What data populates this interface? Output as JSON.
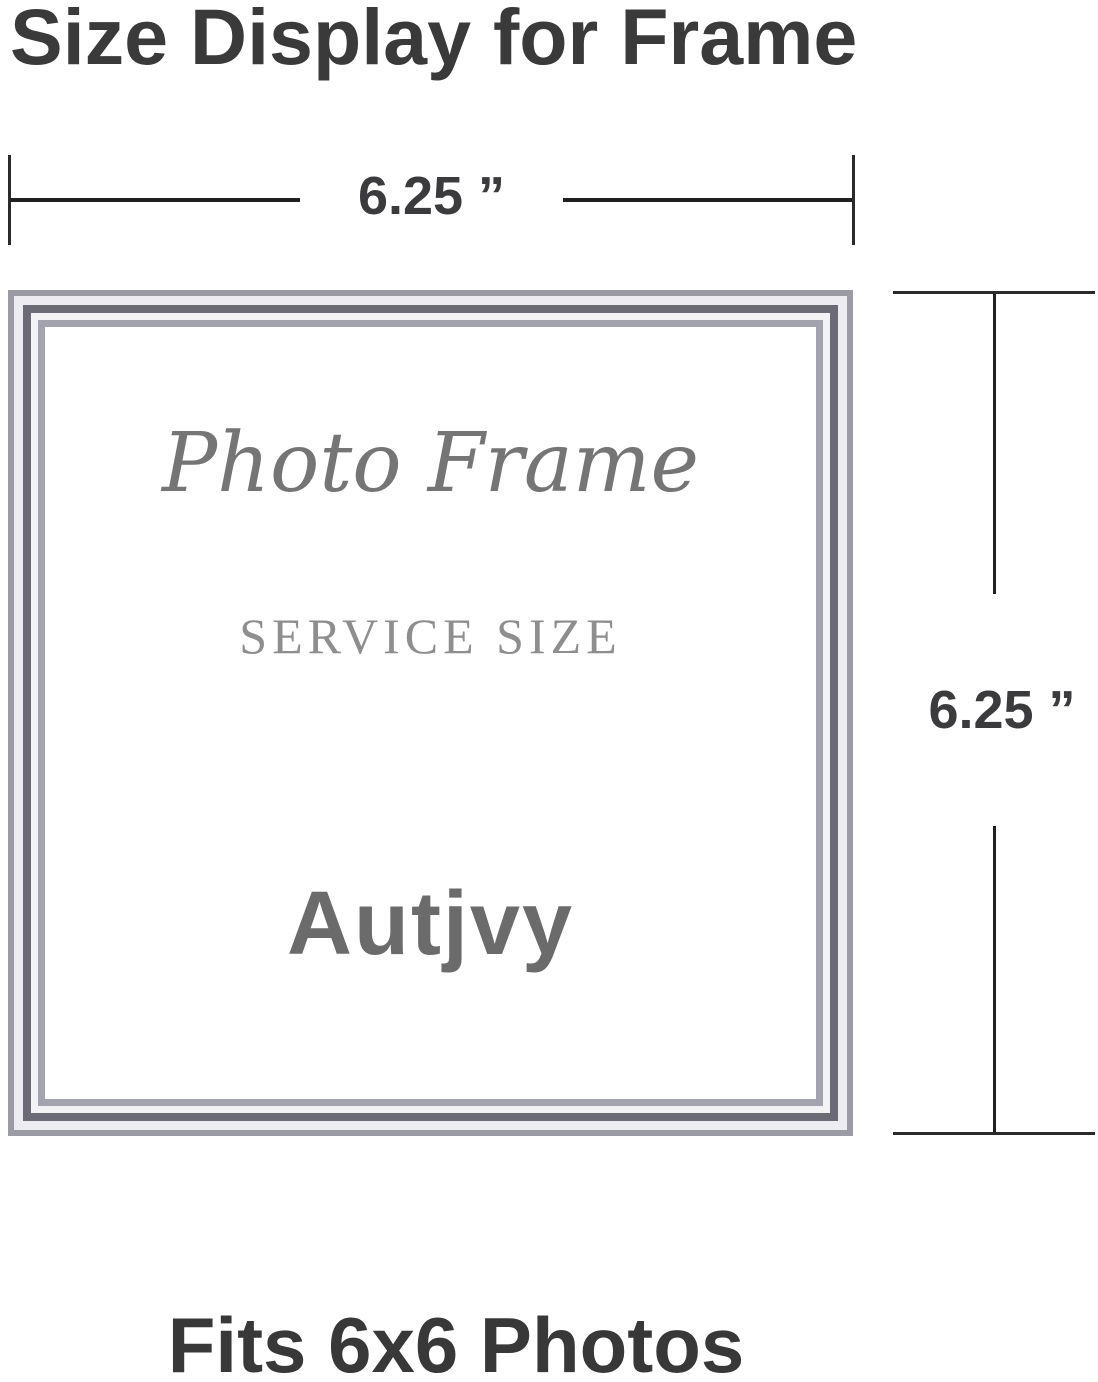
{
  "title": "Size Display for Frame",
  "dimensions": {
    "width_label": "6.25 ”",
    "height_label": "6.25 ”"
  },
  "frame": {
    "script_text": "Photo Frame",
    "engraved_text": "SERVICE SIZE",
    "brand_text": "Autjvy"
  },
  "footer": "Fits 6x6 Photos",
  "colors": {
    "title_text": "#3a3a3a",
    "dimension_line": "#1f1f1f",
    "dimension_tick": "#2a2a2a",
    "dimension_label": "#3b3b3e",
    "frame_outer_line": "#9b9ba3",
    "frame_dark_line": "#6b6b75",
    "frame_inner_line": "#a3a3ad",
    "frame_light_band": "#ededf1",
    "script_text": "#757575",
    "engraved_text": "#8e8e8e",
    "brand_text": "#6b6b6b",
    "footer_text": "#383838",
    "background": "#ffffff"
  }
}
